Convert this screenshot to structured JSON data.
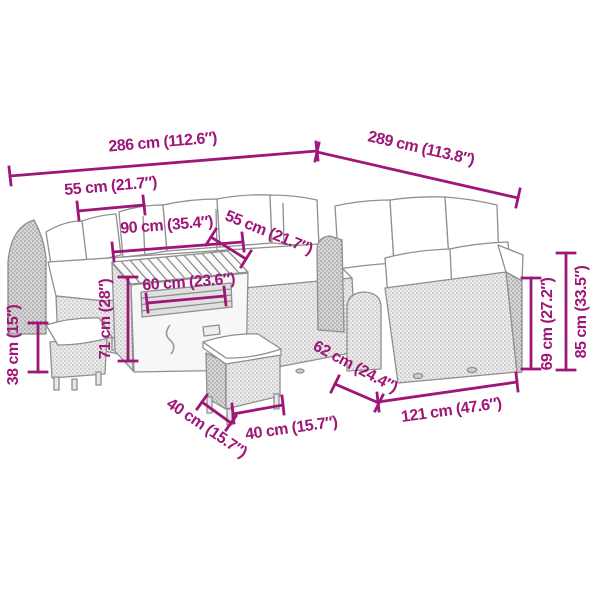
{
  "figure": {
    "type": "product-dimension-diagram",
    "subject": "rattan garden lounge set with cushions, storage table and two stools",
    "accent_color": "#9E1677",
    "background_color": "#ffffff",
    "line_color": "#8f8f8f"
  },
  "labels": {
    "back_width": "286 cm (112.6″)",
    "right_width": "289 cm (113.8″)",
    "left_seat_width": "55 cm (21.7″)",
    "table_length": "90 cm (35.4″)",
    "seat_depth": "55 cm (21.7″)",
    "table_width": "60 cm (23.6″)",
    "table_height": "71 cm (28″)",
    "stool_height": "38 cm (15″)",
    "stool_depth": "40 cm (15.7″)",
    "stool_width": "40 cm (15.7″)",
    "sofa_depth": "62 cm (24.4″)",
    "right_sofa_length": "121 cm (47.6″)",
    "backrest_height": "69 cm (27.2″)",
    "overall_height": "85 cm (33.5″)"
  }
}
